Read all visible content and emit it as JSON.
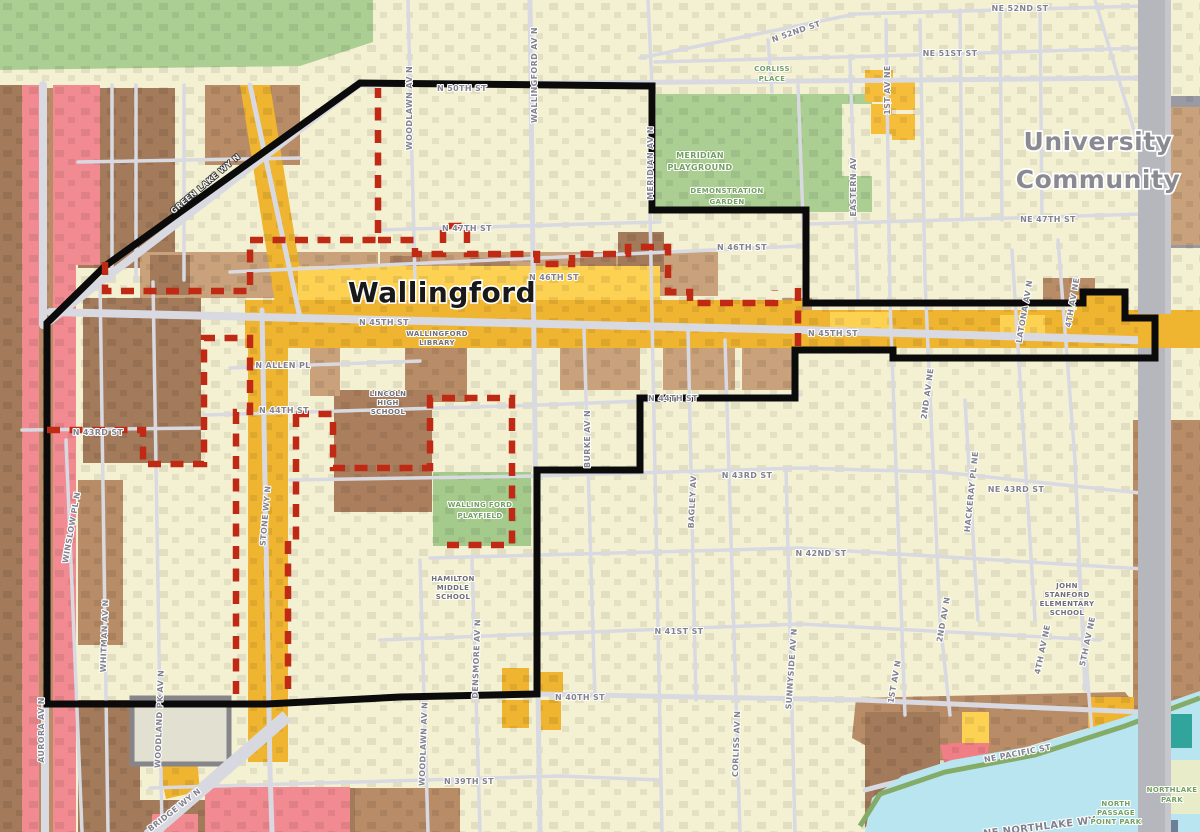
{
  "map": {
    "neighborhood": "Wallingford",
    "adjacent_community": "University Community"
  },
  "colors": {
    "background_single_family": "#f4f1d3",
    "commercial_mustard": "#efb430",
    "commercial_bright_yellow": "#fdd152",
    "multifamily_brown_dark": "#a37a5a",
    "multifamily_brown_mid": "#b88c66",
    "multifamily_brown_light": "#c9a17b",
    "aurora_pink": "#f28a91",
    "park_green": "#abcf92",
    "water_blue": "#b9e5f0",
    "teal_block": "#31a49c",
    "freeway_gray": "#b6b6bd",
    "road_gray": "#d9d9e2",
    "boundary_black": "#0b0b0b",
    "boundary_red_dashed": "#c02a14",
    "street_label_gray": "#82828e",
    "park_label_green": "#74a062"
  },
  "labels": {
    "titles": {
      "wallingford": "Wallingford",
      "university_l1": "University",
      "university_l2": "Community"
    },
    "streets": {
      "ne_52nd": "NE 52ND ST",
      "n_52nd": "N 52ND ST",
      "ne_51st": "NE 51ST ST",
      "n_50th": "N 50TH ST",
      "first_av_ne": "1ST AV NE",
      "eastern_av": "EASTERN AV",
      "ne_47th": "NE 47TH ST",
      "n_47th": "N 47TH ST",
      "woodlawn_av_n_north": "WOODLAWN AV N",
      "wallingford_av_n": "WALLINGFORD AV N",
      "meridian_av_n": "MERIDIAN AV N",
      "n_46th_west": "N 46TH ST",
      "n_46th_east": "N 46TH ST",
      "n_45th_west": "N 45TH ST",
      "n_45th_east": "N 45TH ST",
      "n_allen_pl": "N ALLEN PL",
      "n_44th_west": "N 44TH ST",
      "n_44th_east": "N 44TH ST",
      "n_43rd_west": "N 43RD ST",
      "stone_wy_n": "STONE WY N",
      "winslow_pl_n": "WINSLOW PL N",
      "whitman_av_n": "WHITMAN AV N",
      "aurora_av_n": "AURORA AV N",
      "woodland_pk_av_n": "WOODLAND PK AV N",
      "green_lake_wy_n": "GREEN LAKE WY N",
      "burke_av_n": "BURKE AV N",
      "bagley_av": "BAGLEY AV",
      "n_43rd": "N 43RD ST",
      "ne_43rd": "NE 43RD ST",
      "second_av_ne": "2ND AV NE",
      "hackeray_pl_ne": "HACKERAY PL NE",
      "latona_av_n": "LATONA AV N",
      "fourth_av_ne_north": "4TH AV NE",
      "n_42nd": "N 42ND ST",
      "n_41st": "N 41ST ST",
      "sunnyside_av_n": "SUNNYSIDE AV N",
      "corliss_av_n": "CORLISS AV N",
      "densmore_av_n": "DENSMORE AV N",
      "woodlawn_av_n_south": "WOODLAWN AV N",
      "n_40th": "N 40TH ST",
      "n_39th": "N 39TH ST",
      "first_av_n_south": "1ST AV N",
      "second_av_n_south": "2ND AV N",
      "fourth_av_ne_south": "4TH AV NE",
      "fifth_av_ne": "5TH AV NE",
      "ne_pacific_st": "NE PACIFIC ST",
      "ne_northlake_wy": "NE NORTHLAKE WY",
      "bridge_wy_n": "BRIDGE WY N"
    },
    "places": {
      "corliss_place_l1": "CORLISS",
      "corliss_place_l2": "PLACE",
      "meridian_playground_l1": "MERIDIAN",
      "meridian_playground_l2": "PLAYGROUND",
      "demonstration_garden_l1": "DEMONSTRATION",
      "demonstration_garden_l2": "GARDEN",
      "wallingford_library_l1": "WALLINGFORD",
      "wallingford_library_l2": "LIBRARY",
      "lincoln_high_l1": "LINCOLN",
      "lincoln_high_l2": "HIGH",
      "lincoln_high_l3": "SCHOOL",
      "wallingford_playfield_l1": "WALLING FORD",
      "wallingford_playfield_l2": "PLAYFIELD",
      "hamilton_l1": "HAMILTON",
      "hamilton_l2": "MIDDLE",
      "hamilton_l3": "SCHOOL",
      "john_stanford_l1": "JOHN",
      "john_stanford_l2": "STANFORD",
      "john_stanford_l3": "ELEMENTARY",
      "john_stanford_l4": "SCHOOL",
      "northlake_park_l1": "NORTHLAKE",
      "northlake_park_l2": "PARK",
      "passage_point_l1": "NORTH",
      "passage_point_l2": "PASSAGE",
      "passage_point_l3": "POINT PARK"
    }
  }
}
